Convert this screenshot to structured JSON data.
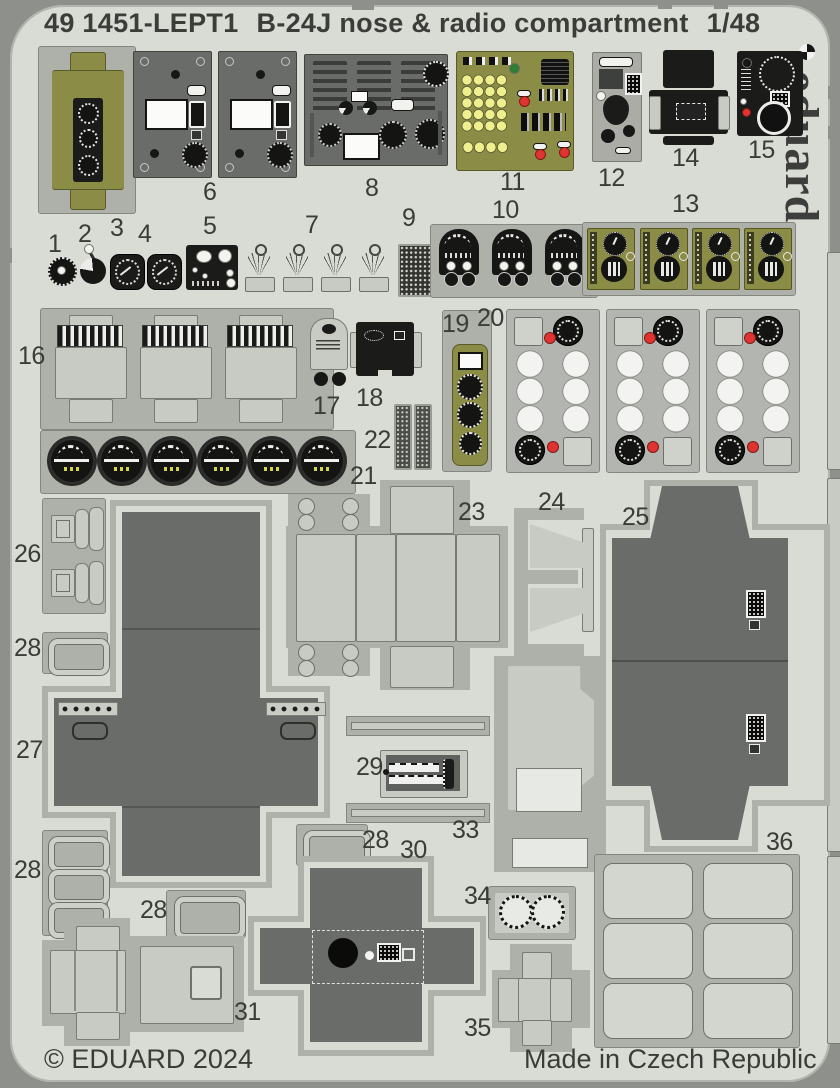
{
  "header": {
    "catalog": "49 1451-LEPT1",
    "title": "B-24J nose & radio compartment",
    "scale": "1/48"
  },
  "brand": {
    "logo": "eduard"
  },
  "footer": {
    "copyright": "© EDUARD 2024",
    "origin": "Made in Czech Republic"
  },
  "colors": {
    "bg": "#8e908b",
    "sheet": "#d9dbd5",
    "carrier": "#aeb0aa",
    "plight": "#c8cac4",
    "pdark": "#6a6c69",
    "pblack": "#1b1b19",
    "olive": "#8b8c45",
    "yellow": "#eded8d",
    "red": "#df3431"
  },
  "part_labels": [
    {
      "n": "1",
      "x": 48,
      "y": 232
    },
    {
      "n": "2",
      "x": 78,
      "y": 222
    },
    {
      "n": "3",
      "x": 110,
      "y": 216
    },
    {
      "n": "4",
      "x": 138,
      "y": 222
    },
    {
      "n": "5",
      "x": 203,
      "y": 214
    },
    {
      "n": "6",
      "x": 203,
      "y": 180
    },
    {
      "n": "7",
      "x": 305,
      "y": 213
    },
    {
      "n": "8",
      "x": 365,
      "y": 176
    },
    {
      "n": "9",
      "x": 402,
      "y": 206
    },
    {
      "n": "10",
      "x": 492,
      "y": 198
    },
    {
      "n": "11",
      "x": 500,
      "y": 170
    },
    {
      "n": "12",
      "x": 598,
      "y": 166
    },
    {
      "n": "13",
      "x": 672,
      "y": 192
    },
    {
      "n": "14",
      "x": 672,
      "y": 146
    },
    {
      "n": "15",
      "x": 748,
      "y": 138
    },
    {
      "n": "16",
      "x": 18,
      "y": 344
    },
    {
      "n": "17",
      "x": 313,
      "y": 394
    },
    {
      "n": "18",
      "x": 356,
      "y": 386
    },
    {
      "n": "19",
      "x": 442,
      "y": 312
    },
    {
      "n": "20",
      "x": 477,
      "y": 306
    },
    {
      "n": "21",
      "x": 350,
      "y": 464
    },
    {
      "n": "22",
      "x": 364,
      "y": 428
    },
    {
      "n": "23",
      "x": 458,
      "y": 500
    },
    {
      "n": "24",
      "x": 538,
      "y": 490
    },
    {
      "n": "25",
      "x": 622,
      "y": 505
    },
    {
      "n": "26",
      "x": 14,
      "y": 542
    },
    {
      "n": "27",
      "x": 16,
      "y": 738
    },
    {
      "n": "28",
      "x": 14,
      "y": 636
    },
    {
      "n": "28",
      "x": 14,
      "y": 858
    },
    {
      "n": "28",
      "x": 362,
      "y": 828
    },
    {
      "n": "28",
      "x": 140,
      "y": 898
    },
    {
      "n": "29",
      "x": 356,
      "y": 755
    },
    {
      "n": "30",
      "x": 400,
      "y": 838
    },
    {
      "n": "31",
      "x": 234,
      "y": 1000
    },
    {
      "n": "33",
      "x": 452,
      "y": 818
    },
    {
      "n": "34",
      "x": 464,
      "y": 884
    },
    {
      "n": "35",
      "x": 464,
      "y": 1016
    },
    {
      "n": "36",
      "x": 766,
      "y": 830
    }
  ]
}
